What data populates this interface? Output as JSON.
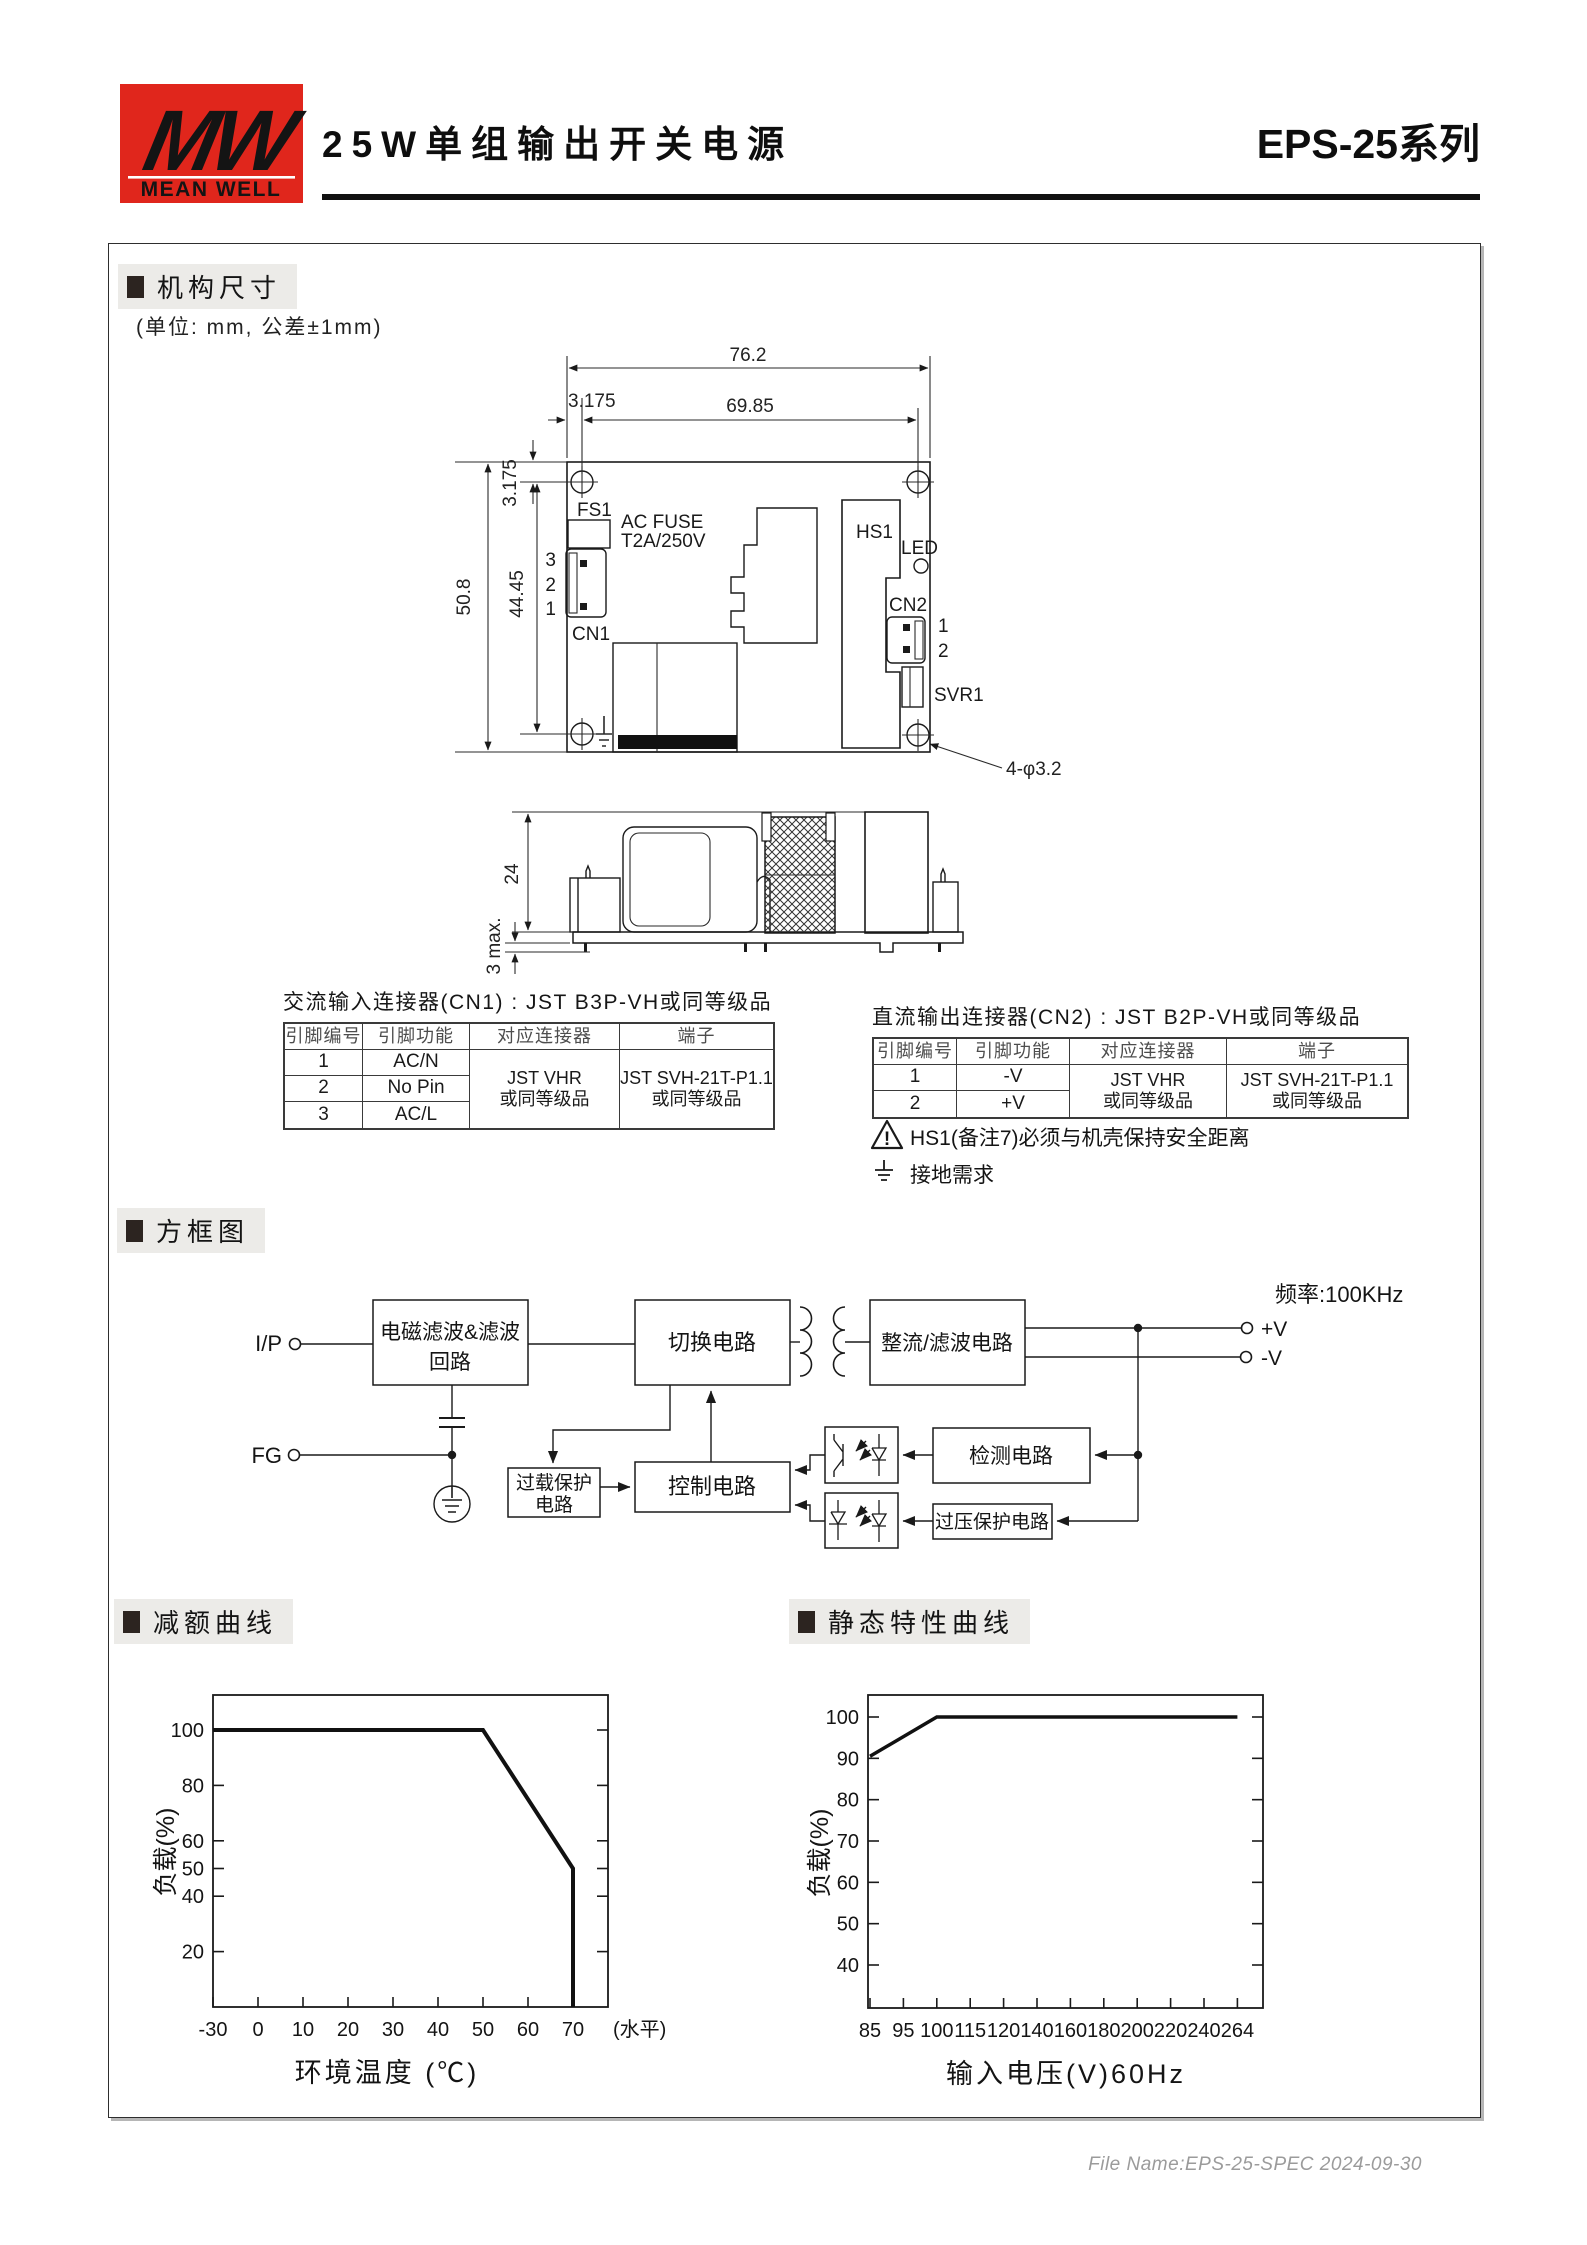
{
  "header": {
    "logo_mw": "MW",
    "logo_brand": "MEAN WELL",
    "title": "25W单组输出开关电源",
    "series": "EPS-25系列"
  },
  "sections": {
    "mechanical": "机构尺寸",
    "unit_note": "(单位: mm, 公差±1mm)",
    "block_diagram": "方框图",
    "derating": "减额曲线",
    "static_curve": "静态特性曲线"
  },
  "top_view": {
    "dim_total_w": "76.2",
    "dim_inner_w": "69.85",
    "dim_offset_top": "3.175",
    "dim_offset_left": "3.175",
    "dim_total_h": "50.8",
    "dim_inner_h": "44.45",
    "hole_note": "4-φ3.2",
    "fs1": "FS1",
    "fuse_line1": "AC FUSE",
    "fuse_line2": "T2A/250V",
    "cn1": "CN1",
    "cn1_pins": [
      "3",
      "2",
      "1"
    ],
    "hs1": "HS1",
    "led": "LED",
    "cn2": "CN2",
    "cn2_pins": [
      "1",
      "2"
    ],
    "svr1": "SVR1"
  },
  "side_view": {
    "dim_height": "24",
    "dim_pin": "3 max."
  },
  "cn1_table": {
    "title": "交流输入连接器(CN1) : JST B3P-VH或同等级品",
    "headers": [
      "引脚编号",
      "引脚功能",
      "对应连接器",
      "端子"
    ],
    "rows": [
      [
        "1",
        "AC/N"
      ],
      [
        "2",
        "No Pin"
      ],
      [
        "3",
        "AC/L"
      ]
    ],
    "connector": [
      "JST VHR",
      "或同等级品"
    ],
    "terminal": [
      "JST SVH-21T-P1.1",
      "或同等级品"
    ]
  },
  "cn2_table": {
    "title": "直流输出连接器(CN2) : JST B2P-VH或同等级品",
    "headers": [
      "引脚编号",
      "引脚功能",
      "对应连接器",
      "端子"
    ],
    "rows": [
      [
        "1",
        "-V"
      ],
      [
        "2",
        "+V"
      ]
    ],
    "connector": [
      "JST VHR",
      "或同等级品"
    ],
    "terminal": [
      "JST SVH-21T-P1.1",
      "或同等级品"
    ]
  },
  "notes": {
    "warn_mark": "!",
    "warning": "HS1(备注7)必须与机壳保持安全距离",
    "ground": "接地需求"
  },
  "block": {
    "freq": "频率:100KHz",
    "ip": "I/P",
    "fg": "FG",
    "pv": "+V",
    "nv": "-V",
    "emi": [
      "电磁滤波&滤波",
      "回路"
    ],
    "sw": "切换电路",
    "rect": "整流/滤波电路",
    "ovl": [
      "过载保护",
      "电路"
    ],
    "ctrl": "控制电路",
    "det": "检测电路",
    "ovp": "过压保护电路"
  },
  "chart_data": [
    {
      "type": "line",
      "title": "减额曲线",
      "xlabel": "环境温度 (℃)",
      "ylabel": "负载(%)",
      "x_suffix": "(水平)",
      "x_ticks": [
        -30,
        0,
        10,
        20,
        30,
        40,
        50,
        60,
        70
      ],
      "y_ticks": [
        20,
        40,
        50,
        60,
        80,
        100
      ],
      "points": [
        [
          -30,
          100
        ],
        [
          50,
          100
        ],
        [
          70,
          50
        ],
        [
          70,
          0
        ]
      ],
      "xlim": [
        -30,
        77
      ],
      "ylim": [
        0,
        112
      ],
      "grid": false,
      "legend": "none"
    },
    {
      "type": "line",
      "title": "静态特性曲线",
      "xlabel": "输入电压(V)60Hz",
      "ylabel": "负载(%)",
      "x_ticks": [
        85,
        95,
        100,
        115,
        120,
        140,
        160,
        180,
        200,
        220,
        240,
        264
      ],
      "y_ticks": [
        40,
        50,
        60,
        70,
        80,
        90,
        100
      ],
      "points": [
        [
          85,
          90.5
        ],
        [
          100,
          100
        ],
        [
          264,
          100
        ]
      ],
      "xlim": [
        85,
        272
      ],
      "ylim": [
        30,
        105
      ],
      "grid": false,
      "legend": "none"
    }
  ],
  "footer": {
    "text": "File Name:EPS-25-SPEC  2024-09-30"
  },
  "colors": {
    "brand_red": "#e0261c",
    "ink": "#1a1a1a",
    "section_bg": "#ecebe8",
    "footer_gray": "#9b9b9b"
  }
}
